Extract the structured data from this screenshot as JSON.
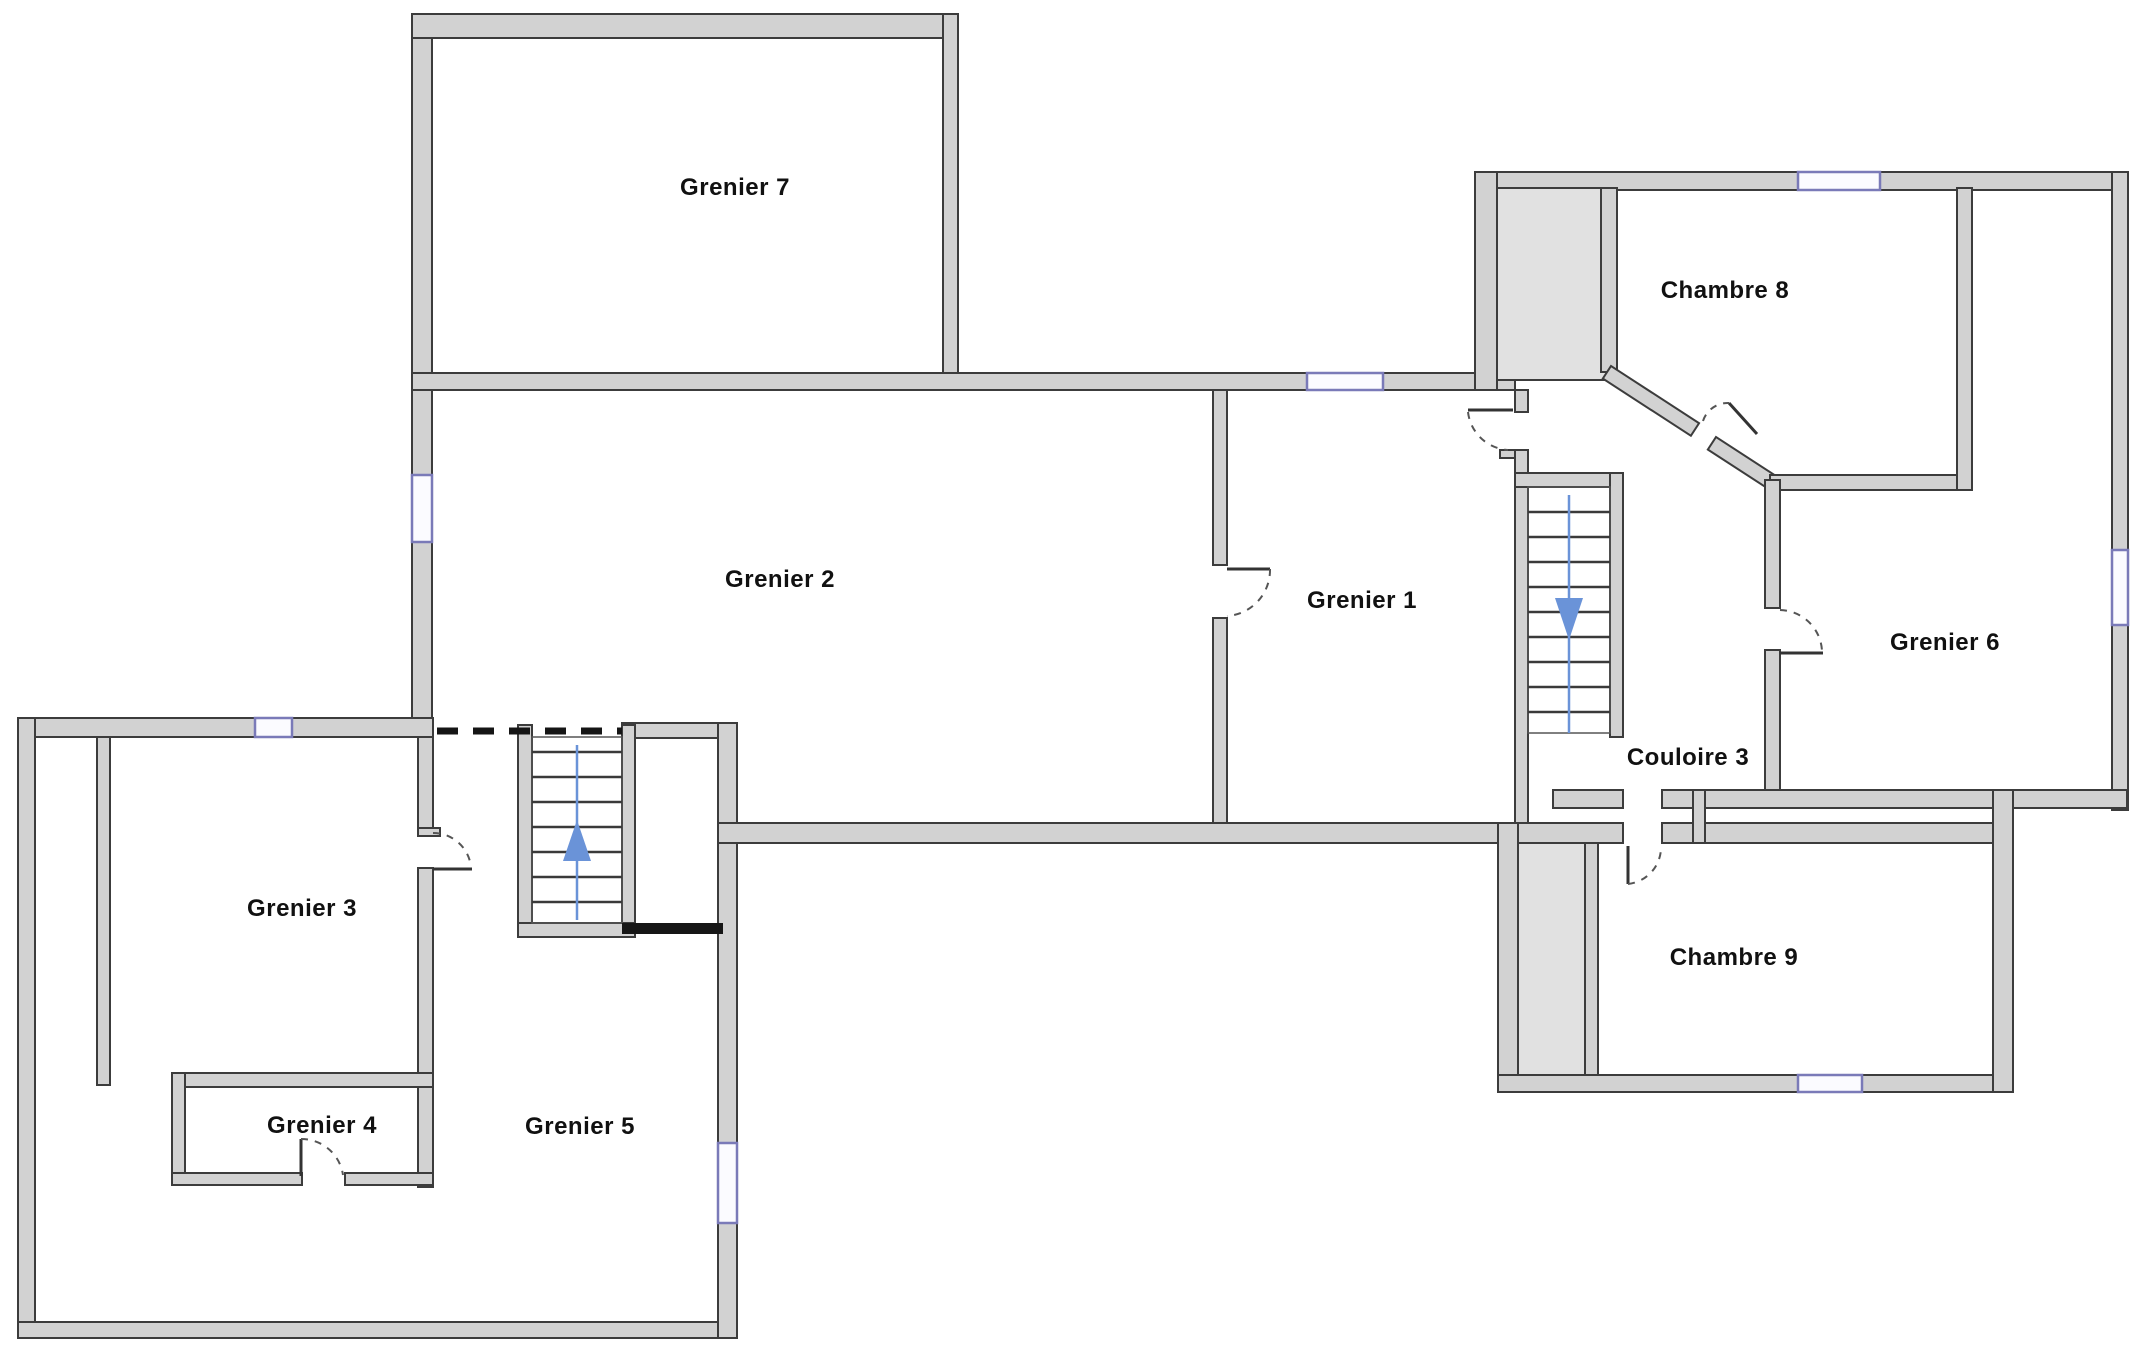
{
  "plan_title": "Floor plan (attic level)",
  "rooms": {
    "grenier7": {
      "label": "Grenier 7"
    },
    "grenier2": {
      "label": "Grenier 2"
    },
    "grenier1": {
      "label": "Grenier 1"
    },
    "chambre8": {
      "label": "Chambre 8"
    },
    "grenier6": {
      "label": "Grenier 6"
    },
    "couloire3": {
      "label": "Couloire 3"
    },
    "chambre9": {
      "label": "Chambre 9"
    },
    "grenier3": {
      "label": "Grenier 3"
    },
    "grenier4": {
      "label": "Grenier 4"
    },
    "grenier5": {
      "label": "Grenier 5"
    }
  },
  "stairs": {
    "left": {
      "direction": "up"
    },
    "right": {
      "direction": "down"
    }
  },
  "colors": {
    "wall_fill": "#d2d2d2",
    "wall_edge": "#3c3c3c",
    "shaft_fill": "#e1e1e1",
    "window": "#7a7ab8",
    "stair_arrow": "#6a93d8",
    "door_line": "#333333",
    "opening_dash": "#151515",
    "background": "#ffffff"
  }
}
